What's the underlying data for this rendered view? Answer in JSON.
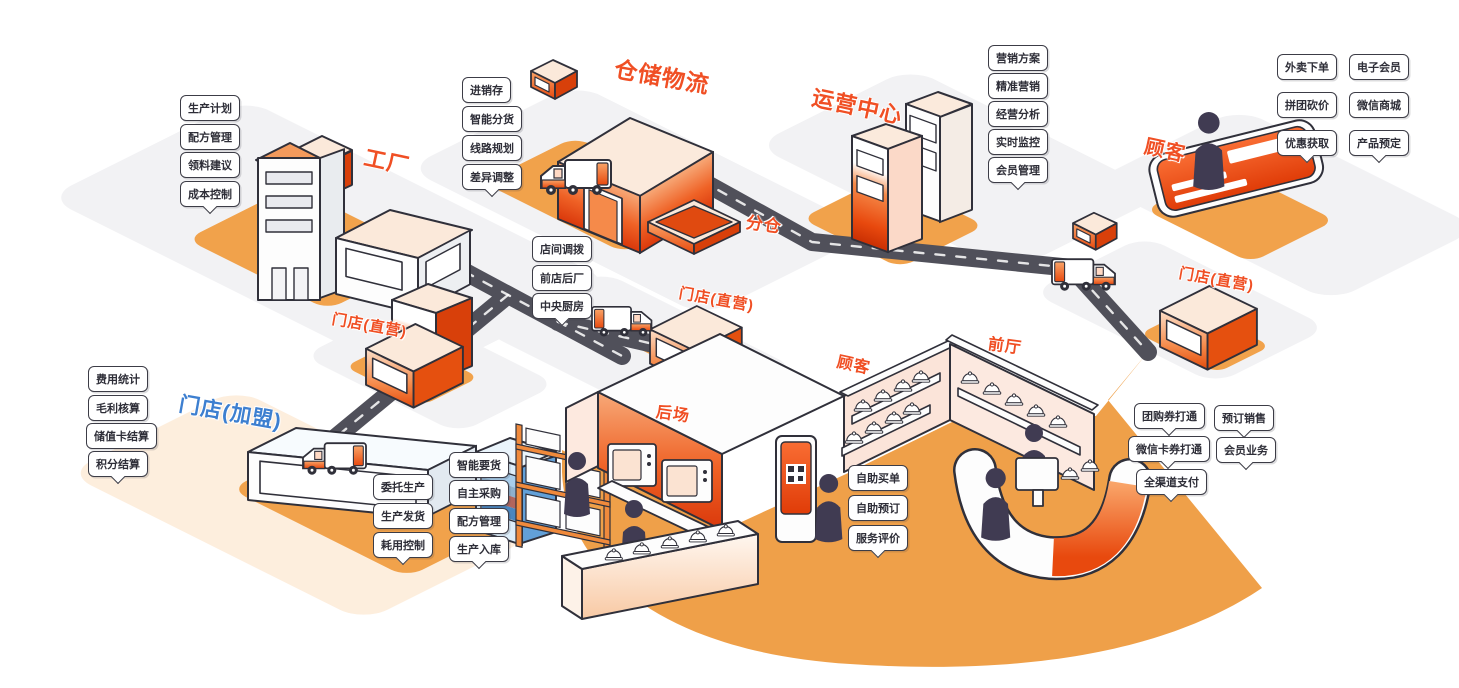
{
  "diagram_title": "连锁门店全渠道运营系统示意图",
  "palette": {
    "accent": "#f04f24",
    "franchise_blue": "#3d7fd0",
    "road": "#50505a",
    "pad_orange": "#f1a24b",
    "floor_orange": "#efa049",
    "outline": "#30303a",
    "plane_gray": "#f2f2f4"
  },
  "titles": {
    "factory": "工厂",
    "warehouse": "仓储物流",
    "sub_warehouse": "分仓",
    "ops_center": "运营中心",
    "customer": "顾客",
    "store_direct": "门店(直营)",
    "store_franchise": "门店(加盟)",
    "back_area": "后场",
    "customer_hall": "顾客",
    "front_hall": "前厅"
  },
  "callouts": {
    "factory": [
      "生产计划",
      "配方管理",
      "领料建议",
      "成本控制"
    ],
    "warehouse": [
      "进销存",
      "智能分货",
      "线路规划",
      "差异调整"
    ],
    "ops": [
      "营销方案",
      "精准营销",
      "经营分析",
      "实时监控",
      "会员管理"
    ],
    "customer": [
      "外卖下单",
      "电子会员",
      "拼团砍价",
      "微信商城",
      "优惠获取",
      "产品预定"
    ],
    "transfer": [
      "店间调拨",
      "前店后厂",
      "中央厨房"
    ],
    "franchise": [
      "费用统计",
      "毛利核算",
      "储值卡结算",
      "积分结算"
    ],
    "production": [
      "委托生产",
      "生产发货",
      "耗用控制"
    ],
    "supply": [
      "智能要货",
      "自主采购",
      "配方管理",
      "生产入库"
    ],
    "self_service": [
      "自助买单",
      "自助预订",
      "服务评价"
    ],
    "channel": [
      "团购券打通",
      "预订销售",
      "微信卡券打通",
      "会员业务",
      "全渠道支付"
    ]
  }
}
